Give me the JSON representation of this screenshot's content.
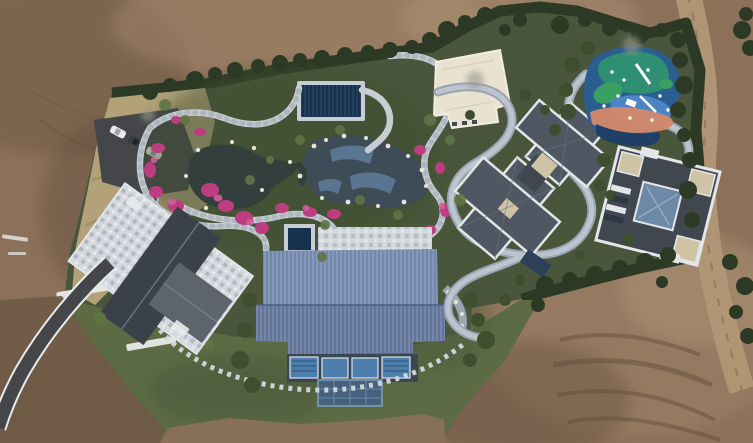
{
  "scene": {
    "type": "aerial-drone-photograph",
    "description": "Top-down aerial drone photo of a landscaped private estate surrounded by bare brown earthworks: a central Japanese-style water garden with winding stone paths, dark ponds and pink azalea beds, a navy-covered pool, a large hall with a ribbed blue metal roof, a stone-paved house at left with parking pad and three cars on a curving asphalt driveway, a cream flat-roof pavilion, two gray hip-roof villas with white trim at right, a colorful swirled children's playground at top right, and a dirt access road along the right edge.",
    "lighting": "overcast daylight",
    "counts": {
      "cars": 3,
      "villas": 2,
      "ponds": 2,
      "playgrounds": 1
    },
    "car_colors": [
      "white",
      "dark-gray",
      "white"
    ]
  },
  "palette": {
    "dirt-base": "#8c715a",
    "dirt-dark": "#6f5a45",
    "dirt-darker": "#5d4a39",
    "dirt-light": "#a2876a",
    "dirt-pale": "#b29878",
    "track-shadow": "#5e4b39",
    "tree-dark": "#2c3a25",
    "tree-mid": "#3d4f2f",
    "tree-light": "#5f7544",
    "garden-base": "#49563b",
    "lawn": "#5c6b44",
    "lawn-dark": "#4c5c3c",
    "dry-grass": "#b2a179",
    "dry-grass-dark": "#9c8a62",
    "asphalt": "#454649",
    "curb-white": "#e9eaea",
    "stone-path": "#c7cdd3",
    "stone-shadow": "#a9b1b9",
    "terrace": "#d3d8dd",
    "terrace-dark": "#b0b8c0",
    "pond": "#333f3d",
    "pond-blue": "#3e4c57",
    "stream-tile": "#5e7d9a",
    "rock-white": "#e7e2d4",
    "flower": "#bc3d80",
    "flower-light": "#d35f9c",
    "roof-blue": "#7289ad",
    "roof-blue-dark": "#62759a",
    "facade-dark": "#3c4652",
    "window-glass": "#4d7fae",
    "canopy-blue": "#46617e",
    "house-roof": "#3a4149",
    "house-wing": "#5d646c",
    "roof-gray": "#4f5763",
    "roof-gray-dark": "#40474f",
    "trim-white": "#e3e6e9",
    "skylight-tan": "#cfc3a5",
    "skylight-glass": "#6d89a8",
    "pavilion-cream": "#e9e2d0",
    "pool-navy": "#16324f",
    "play-base": "#2b5d8f",
    "play-teal": "#2f8f72",
    "play-green": "#3aa061",
    "play-blue": "#4a85c4",
    "play-coral": "#d4886a",
    "play-navy": "#1f3f66",
    "car-white": "#e9e9e9",
    "car-dark": "#3a3d40",
    "path-stone": "#9aa5b1",
    "path-stone-light": "#bcc5cf"
  }
}
